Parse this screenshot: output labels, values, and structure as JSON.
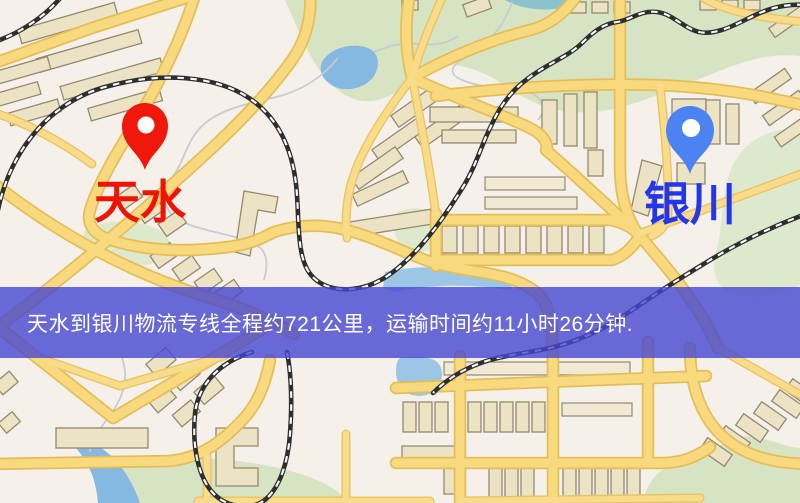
{
  "banner": {
    "text": "天水到银川物流专线全程约721公里，运输时间约11小时26分钟.",
    "background": "rgba(70,70,210,0.8)",
    "text_color": "#ffffff"
  },
  "map": {
    "origin": {
      "label": "天水",
      "pin_color": "#f0180a",
      "label_color": "#ee1404"
    },
    "destination": {
      "label": "银川",
      "pin_color": "#4b84f2",
      "label_color": "#2336ec"
    },
    "terrain": {
      "background": "#f6f0ea",
      "road": "#f8d97e",
      "park": "#d7e4c3",
      "water": "#86b9e2",
      "railway": "#2e2e2e"
    }
  }
}
